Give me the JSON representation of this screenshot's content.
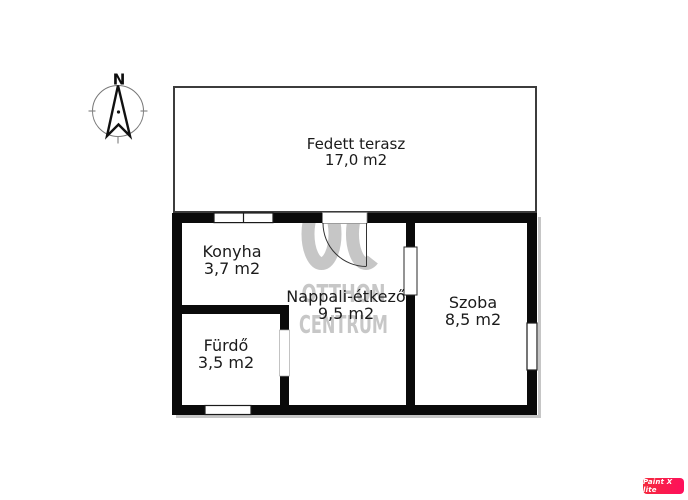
{
  "floorplan": {
    "rooms": [
      {
        "name": "Fedett terasz",
        "area": "17,0 m2"
      },
      {
        "name": "Konyha",
        "area": "3,7 m2"
      },
      {
        "name": "Nappali-étkező",
        "area": "9,5 m2"
      },
      {
        "name": "Szoba",
        "area": "8,5 m2"
      },
      {
        "name": "Fürdő",
        "area": "3,5 m2"
      }
    ],
    "compass": {
      "north_label": "N"
    },
    "watermark": {
      "logo": "OC",
      "line1": "OTTHON",
      "line2": "CENTRUM"
    },
    "colors": {
      "wall": "#0a0a0a",
      "terrace_outline": "#3c3c3c",
      "label_text": "#1b1b1b",
      "watermark_gray": "#c6c6c6",
      "badge_red": "#f42a3b",
      "badge_pink": "#ff0e5e"
    }
  },
  "badge": {
    "label": "Paint X lite"
  }
}
